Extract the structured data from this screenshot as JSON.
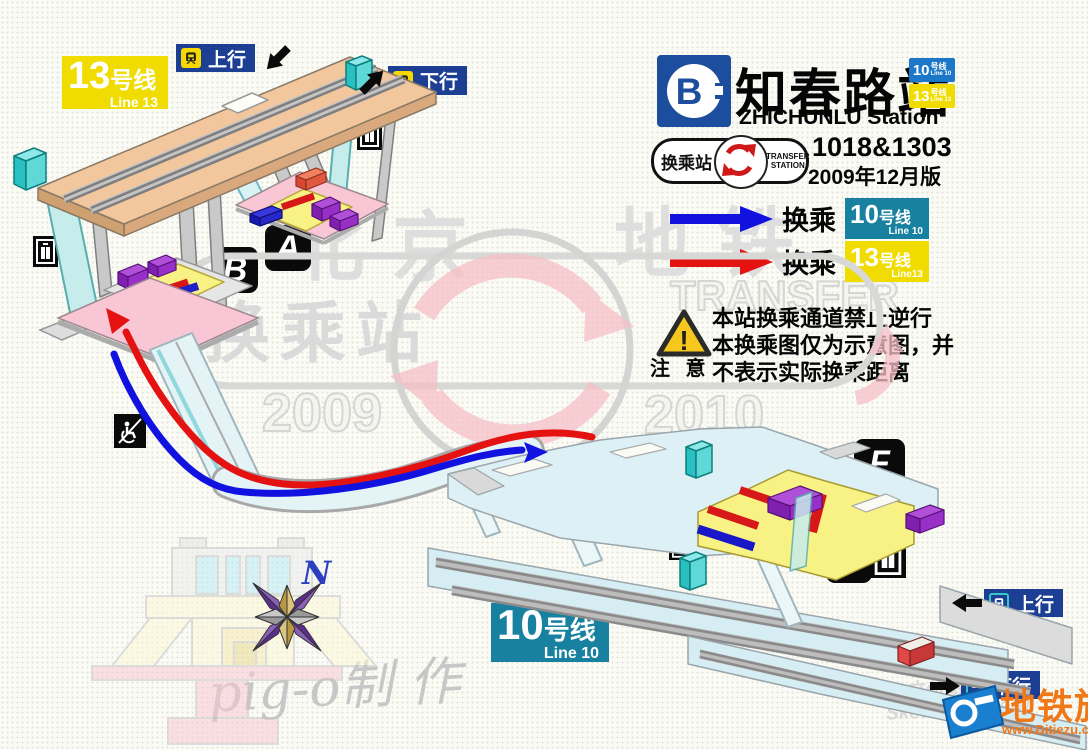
{
  "colors": {
    "line10_teal": "#17819F",
    "line10_header_blue": "#1B78C8",
    "line13_yellow": "#F0DC00",
    "direction_badge_blue": "#1C3F94",
    "transfer_arrow_blue": "#1111E0",
    "transfer_arrow_red": "#E51212",
    "subway_logo_blue": "#1D4E9E",
    "site_orange": "#F07818"
  },
  "header": {
    "logo_letter": "B",
    "station_name_zh": "知春路站",
    "station_name_en": "ZHICHUNLU Station",
    "badge_line10": {
      "number": "10",
      "unit": "号线",
      "sub": "Line 10"
    },
    "badge_line13": {
      "number": "13",
      "unit": "号线",
      "sub": "Line 13"
    },
    "transfer_emblem": {
      "zh": "换乘站",
      "en_line1": "TRANSFER",
      "en_line2": "STATION"
    },
    "station_codes": "1018&1303",
    "edition": "2009年12月版"
  },
  "legend": {
    "row1": {
      "label": "换乘",
      "line_number": "10",
      "line_unit": "号线",
      "line_sub": "Line 10"
    },
    "row2": {
      "label": "换乘",
      "line_number": "13",
      "line_unit": "号线",
      "line_sub": "Line13"
    }
  },
  "notice": {
    "title": "注 意",
    "mark": "!",
    "line1": "本站换乘通道禁止逆行",
    "line2": "本换乘图仅为示意图，并",
    "line3": "不表示实际换乘距离"
  },
  "line13_area": {
    "badge": {
      "number": "13",
      "unit": "号线",
      "sub": "Line 13"
    },
    "up_label": "上行",
    "down_label": "下行"
  },
  "line10_area": {
    "badge": {
      "number": "10",
      "unit": "号线",
      "sub": "Line 10"
    },
    "up_label": "上行",
    "down_label": "下行"
  },
  "exits": {
    "a": "A",
    "b": "B",
    "f": "F",
    "g": "G"
  },
  "watermarks": {
    "city": "北京",
    "metro": "地铁",
    "transfer_station": "换乘站",
    "transfer_en": "TRANSFER",
    "year_left": "2009",
    "year_right": "2010",
    "compass_north": "N",
    "author": "pig-o制 作",
    "tool_line1": "立体图模拟",
    "tool_line2": "SketchUp 5绘制"
  },
  "site_logo": {
    "name": "地铁族",
    "url": "www.Ditiezu.com"
  }
}
